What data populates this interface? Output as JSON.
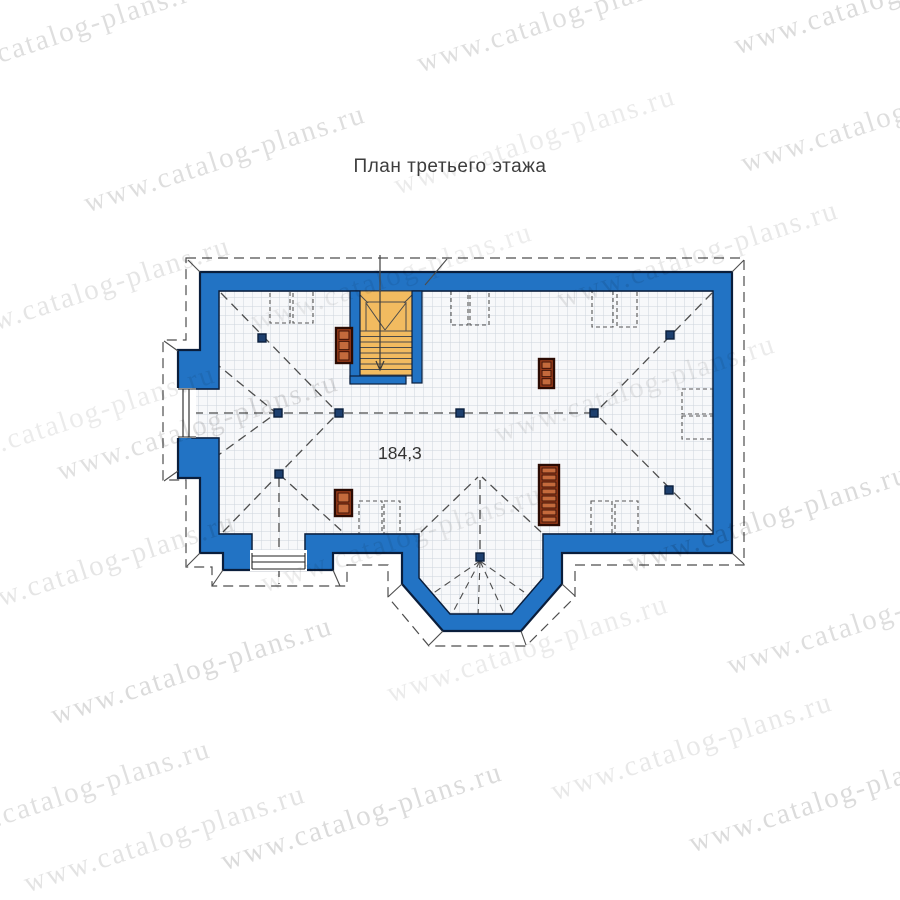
{
  "title": {
    "text": "План третьего этажа"
  },
  "plan": {
    "area_label": "184,3",
    "colors": {
      "wall_fill": "#2273c4",
      "wall_outline": "#0a1e3c",
      "wall_inner_shade": "#123158",
      "floor_fill": "#f7f8fa",
      "grid_line": "#cdd4dc",
      "stair_fill": "#f2bb60",
      "stair_line": "#4a4a4a",
      "chimney_fill": "#9f3f1c",
      "chimney_cell": "#c46a3c",
      "chimney_outline": "#2b0b03",
      "dash_line": "#4d4d4d",
      "post_fill": "#1d3f6e",
      "label_color": "#3d3d3d"
    },
    "posts": [
      [
        262,
        338
      ],
      [
        278,
        413
      ],
      [
        339,
        413
      ],
      [
        460,
        413
      ],
      [
        594,
        413
      ],
      [
        670,
        335
      ],
      [
        669,
        490
      ],
      [
        279,
        474
      ],
      [
        480,
        557
      ]
    ],
    "chimneys": [
      {
        "x": 336,
        "y": 328,
        "w": 16,
        "h": 35,
        "cells": 3
      },
      {
        "x": 539,
        "y": 359,
        "w": 15,
        "h": 29,
        "cells": 3
      },
      {
        "x": 539,
        "y": 465,
        "w": 20,
        "h": 60,
        "cells": 8
      },
      {
        "x": 335,
        "y": 490,
        "w": 17,
        "h": 26,
        "cells": 2
      }
    ],
    "skylights": [
      [
        270,
        291,
        20,
        32
      ],
      [
        293,
        291,
        20,
        32
      ],
      [
        451,
        291,
        17,
        34
      ],
      [
        470,
        291,
        19,
        34
      ],
      [
        592,
        291,
        21,
        36
      ],
      [
        617,
        291,
        20,
        36
      ],
      [
        682,
        389,
        31,
        25
      ],
      [
        682,
        416,
        31,
        23
      ],
      [
        591,
        501,
        21,
        33
      ],
      [
        615,
        501,
        23,
        33
      ],
      [
        359,
        501,
        23,
        33
      ],
      [
        384,
        501,
        16,
        33
      ]
    ],
    "roof_dash_lines": [
      [
        194,
        413,
        590,
        413
      ],
      [
        221,
        293,
        336,
        411
      ],
      [
        223,
        532,
        336,
        415
      ],
      [
        202,
        352,
        275,
        412
      ],
      [
        202,
        467,
        275,
        414
      ],
      [
        712,
        293,
        597,
        411
      ],
      [
        712,
        531,
        597,
        415
      ],
      [
        279,
        474,
        344,
        533
      ],
      [
        279,
        478,
        279,
        584
      ],
      [
        421,
        532,
        478,
        477
      ],
      [
        541,
        532,
        482,
        477
      ],
      [
        480,
        480,
        480,
        552
      ]
    ],
    "fan_rays": [
      [
        480,
        561,
        432,
        594
      ],
      [
        480,
        561,
        453,
        612
      ],
      [
        480,
        561,
        478,
        617
      ],
      [
        480,
        561,
        503,
        611
      ],
      [
        480,
        561,
        524,
        592
      ]
    ],
    "ticks": [
      [
        188,
        260,
        200,
        272
      ],
      [
        744,
        260,
        732,
        272
      ],
      [
        744,
        564,
        732,
        553
      ],
      [
        575,
        596,
        562,
        584
      ],
      [
        526,
        645,
        521,
        631
      ],
      [
        429,
        645,
        443,
        631
      ],
      [
        388,
        597,
        402,
        584
      ],
      [
        340,
        586,
        333,
        570
      ],
      [
        212,
        586,
        223,
        570
      ],
      [
        187,
        566,
        200,
        553
      ],
      [
        164,
        341,
        178,
        351
      ],
      [
        164,
        481,
        178,
        471
      ],
      [
        425,
        285,
        447,
        259
      ],
      [
        380,
        255,
        380,
        291
      ]
    ]
  },
  "watermark": {
    "text": "www.catalog-plans.ru",
    "angle_deg": -18,
    "font_size": 29,
    "instances": [
      {
        "x": -75,
        "y": 62,
        "o": 0.13
      },
      {
        "x": 418,
        "y": 48,
        "o": 0.13
      },
      {
        "x": 735,
        "y": 30,
        "o": 0.14
      },
      {
        "x": 85,
        "y": 188,
        "o": 0.13
      },
      {
        "x": 395,
        "y": 170,
        "o": 0.08
      },
      {
        "x": 742,
        "y": 148,
        "o": 0.13
      },
      {
        "x": -50,
        "y": 320,
        "o": 0.1
      },
      {
        "x": 252,
        "y": 306,
        "o": 0.07
      },
      {
        "x": 558,
        "y": 284,
        "o": 0.09
      },
      {
        "x": -65,
        "y": 448,
        "o": 0.08
      },
      {
        "x": 495,
        "y": 418,
        "o": 0.08
      },
      {
        "x": 58,
        "y": 456,
        "o": 0.12
      },
      {
        "x": 628,
        "y": 548,
        "o": 0.14
      },
      {
        "x": -45,
        "y": 596,
        "o": 0.1
      },
      {
        "x": 262,
        "y": 568,
        "o": 0.08
      },
      {
        "x": 52,
        "y": 700,
        "o": 0.14
      },
      {
        "x": 388,
        "y": 678,
        "o": 0.08
      },
      {
        "x": 728,
        "y": 650,
        "o": 0.13
      },
      {
        "x": -70,
        "y": 823,
        "o": 0.12
      },
      {
        "x": 222,
        "y": 846,
        "o": 0.14
      },
      {
        "x": 552,
        "y": 776,
        "o": 0.09
      },
      {
        "x": 690,
        "y": 828,
        "o": 0.14
      },
      {
        "x": 25,
        "y": 868,
        "o": 0.11
      }
    ]
  }
}
